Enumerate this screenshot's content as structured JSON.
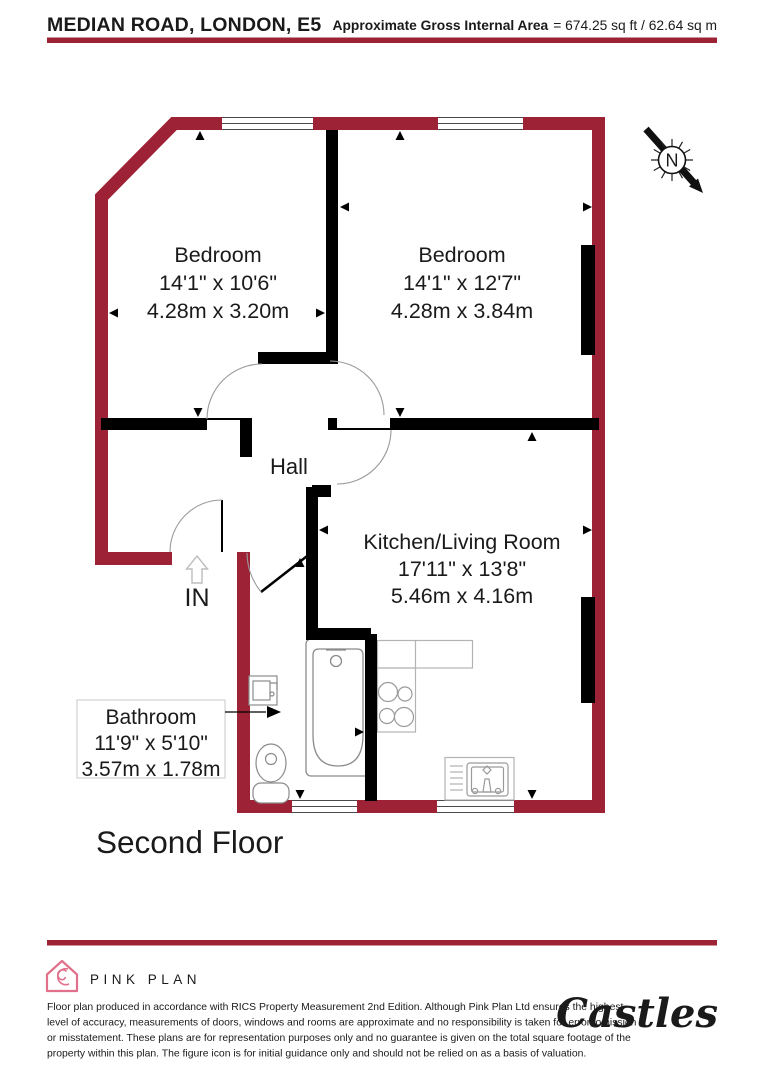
{
  "header": {
    "title": "MEDIAN ROAD, LONDON, E5",
    "area_label": "Approximate Gross Internal Area",
    "area_value": "= 674.25 sq ft / 62.64 sq m"
  },
  "compass": {
    "letter": "N"
  },
  "rooms": {
    "bedroom1": {
      "name": "Bedroom",
      "imperial": "14'1\" x 10'6\"",
      "metric": "4.28m x 3.20m"
    },
    "bedroom2": {
      "name": "Bedroom",
      "imperial": "14'1\" x 12'7\"",
      "metric": "4.28m x 3.84m"
    },
    "hall": {
      "name": "Hall"
    },
    "kitchen_living": {
      "name": "Kitchen/Living Room",
      "imperial": "17'11\" x 13'8\"",
      "metric": "5.46m x 4.16m"
    },
    "bathroom": {
      "name": "Bathroom",
      "imperial": "11'9\" x 5'10\"",
      "metric": "3.57m x 1.78m"
    }
  },
  "entrance_label": "IN",
  "floor_label": "Second Floor",
  "footer": {
    "brand": "PINK PLAN",
    "agency": "Castles",
    "disclaimer_lines": [
      "Floor plan produced in accordance with RICS Property Measurement 2nd Edition. Although Pink Plan Ltd ensures the highest",
      "level of accuracy, measurements of doors, windows and rooms are approximate and no responsibility is taken for error, omission",
      "or misstatement. These plans are for representation purposes only and no guarantee is given on the total square footage of the",
      "property within this plan. The figure icon is for initial guidance only and should not be relied on as a basis of valuation."
    ]
  },
  "colors": {
    "wall": "#9d2235",
    "interior_wall": "#000000",
    "brand_pink": "#e0708c",
    "agency_red": "#9c1d37"
  }
}
